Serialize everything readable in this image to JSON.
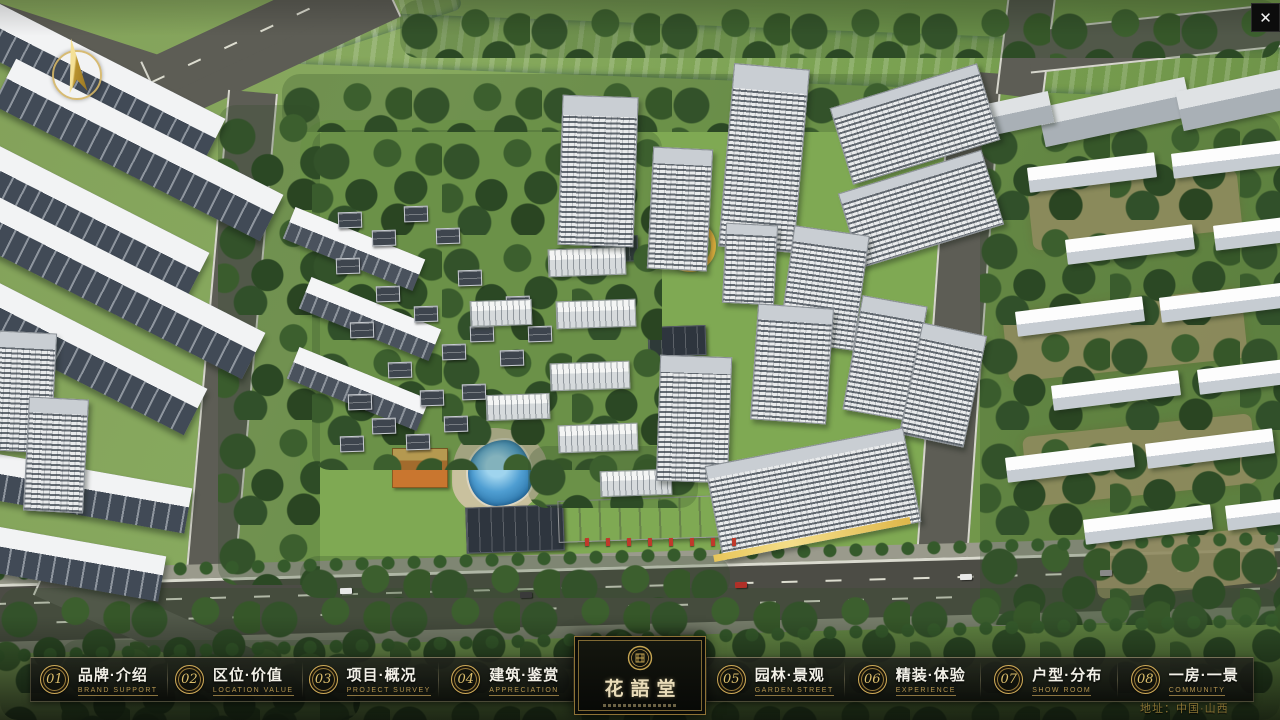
{
  "window": {
    "close_label": "✕"
  },
  "menu": {
    "items": [
      {
        "num": "01",
        "zh": "品牌·介绍",
        "en": "BRAND SUPPORT"
      },
      {
        "num": "02",
        "zh": "区位·价值",
        "en": "LOCATION VALUE"
      },
      {
        "num": "03",
        "zh": "项目·概况",
        "en": "PROJECT SURVEY"
      },
      {
        "num": "04",
        "zh": "建筑·鉴赏",
        "en": "APPRECIATION"
      },
      {
        "num": "05",
        "zh": "园林·景观",
        "en": "GARDEN STREET"
      },
      {
        "num": "06",
        "zh": "精装·体验",
        "en": "EXPERIENCE"
      },
      {
        "num": "07",
        "zh": "户型·分布",
        "en": "SHOW ROOM"
      },
      {
        "num": "08",
        "zh": "一房·一景",
        "en": "COMMUNITY"
      }
    ]
  },
  "logo": {
    "title": "花語堂"
  },
  "footer": {
    "address": "地址：中国·山西"
  },
  "colors": {
    "gold": "#c9a854",
    "gold_dim": "#a8894a",
    "bar_bg": "rgba(10,12,9,0.85)",
    "text": "#f2f0e6",
    "river": "#4b80b4",
    "grass": "#7ba252"
  }
}
